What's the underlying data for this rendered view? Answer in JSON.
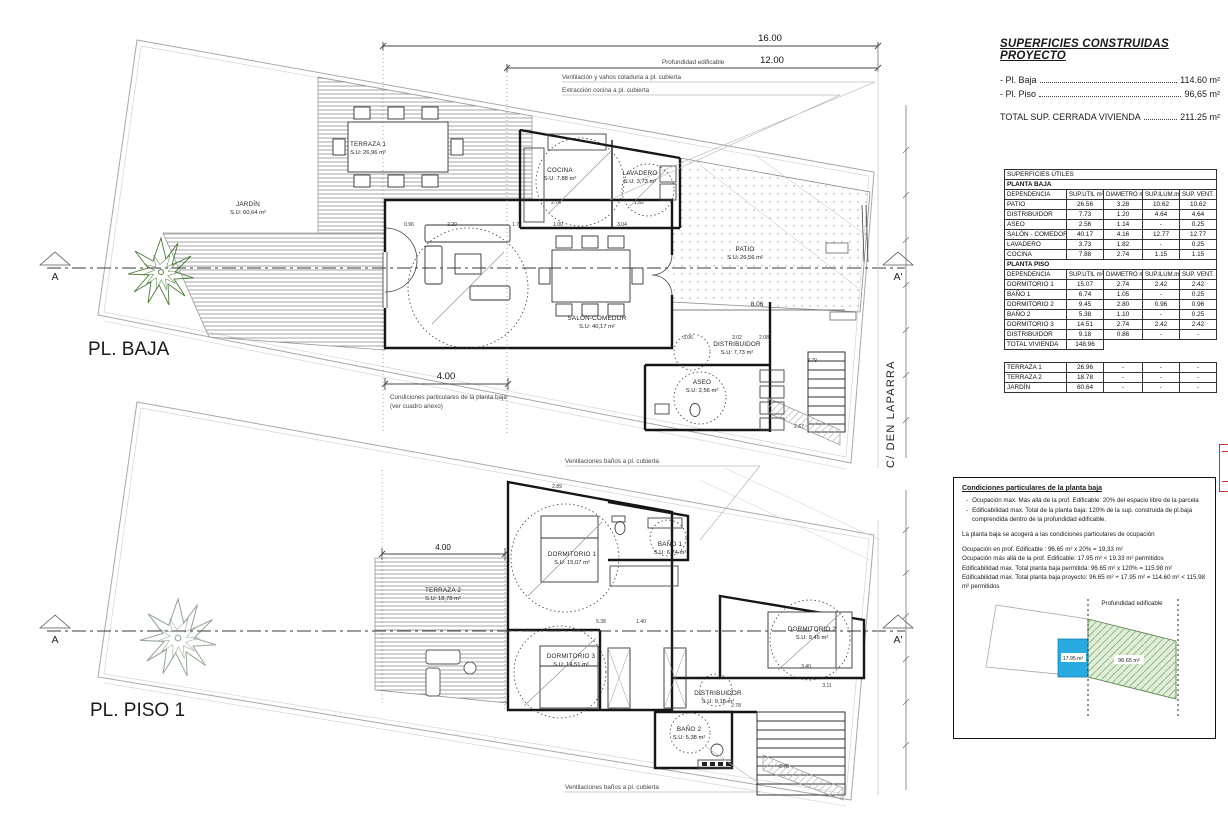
{
  "title_block": {
    "title": "SUPERFICIES CONSTRUIDAS PROYECTO",
    "items": [
      {
        "label": "- Pl. Baja",
        "value": "114.60 m²"
      },
      {
        "label": "- Pl. Piso",
        "value": "96,65 m²"
      }
    ],
    "total_label": "TOTAL SUP. CERRADA VIVIENDA",
    "total_value": "211.25 m²"
  },
  "areas_table": {
    "rows": [
      {
        "kind": "title",
        "cells": [
          "SUPERFICIES ÚTILES"
        ]
      },
      {
        "kind": "section",
        "cells": [
          "PLANTA BAJA"
        ]
      },
      {
        "kind": "header",
        "cells": [
          "DEPENDENCIA",
          "SUP.UTIL m²",
          "DIAMETRO m.",
          "SUP.ILUM.m²",
          "SUP. VENT. m²"
        ]
      },
      {
        "kind": "data",
        "cells": [
          "PATIO",
          "26.56",
          "3.28",
          "10.62",
          "10.62"
        ]
      },
      {
        "kind": "data",
        "cells": [
          "DISTRIBUIDOR",
          "7.73",
          "1.20",
          "4.64",
          "4.64"
        ]
      },
      {
        "kind": "data",
        "cells": [
          "ASEO",
          "2.56",
          "1.14",
          "-",
          "0.25"
        ]
      },
      {
        "kind": "data",
        "cells": [
          "SALÓN - COMEDOR",
          "40.17",
          "4.16",
          "12.77",
          "12.77"
        ]
      },
      {
        "kind": "data",
        "cells": [
          "LAVADERO",
          "3.73",
          "1.82",
          "-",
          "0.25"
        ]
      },
      {
        "kind": "data",
        "cells": [
          "COCINA",
          "7.88",
          "2.74",
          "1.15",
          "1.15"
        ]
      },
      {
        "kind": "section",
        "cells": [
          "PLANTA PISO"
        ]
      },
      {
        "kind": "header",
        "cells": [
          "DEPENDENCIA",
          "SUP.UTIL m²",
          "DIAMETRO m.",
          "SUP.ILUM.m²",
          "SUP. VENT. m²"
        ]
      },
      {
        "kind": "data",
        "cells": [
          "DORMITORIO 1",
          "15.07",
          "2.74",
          "2.42",
          "2.42"
        ]
      },
      {
        "kind": "data",
        "cells": [
          "BAÑO 1",
          "6.74",
          "1.05",
          "-",
          "0.25"
        ]
      },
      {
        "kind": "data",
        "cells": [
          "DORMITORIO 2",
          "9.45",
          "2.80",
          "0.96",
          "0.96"
        ]
      },
      {
        "kind": "data",
        "cells": [
          "BAÑO 2",
          "5.38",
          "1.10",
          "-",
          "0.25"
        ]
      },
      {
        "kind": "data",
        "cells": [
          "DORMITORIO 3",
          "14.51",
          "2.74",
          "2.42",
          "2.42"
        ]
      },
      {
        "kind": "data",
        "cells": [
          "DISTRIBUIDOR",
          "9.18",
          "0.86",
          "-",
          "-"
        ]
      },
      {
        "kind": "total",
        "cells": [
          "TOTAL VIVIENDA",
          "148.96"
        ]
      },
      {
        "kind": "gap",
        "cells": []
      },
      {
        "kind": "data",
        "cells": [
          "TERRAZA 1",
          "26.96",
          "-",
          "-",
          "-"
        ]
      },
      {
        "kind": "data",
        "cells": [
          "TERRAZA 2",
          "18.78",
          "-",
          "-",
          "-"
        ]
      },
      {
        "kind": "data",
        "cells": [
          "JARDÍN",
          "60.64",
          "-",
          "-",
          "-"
        ]
      }
    ]
  },
  "conditions_box": {
    "title": "Condiciones particulares de la planta baja",
    "bullets": [
      "Ocupación max.  Más allá de la prof. Edificable: 20% del espacio libre de la parcela",
      "Edificabilidad max. Total de la planta baja: 120% de la sup. construida de pl.baja comprendida dentro de la profundidad edificable."
    ],
    "note": "La planta baja se acogerá a las condiciones particulares de ocupación",
    "calcs": [
      "Ocupación en prof. Edificable : 96.65 m² x 20% = 19,33 m²",
      "Ocupación más allá de la prof. Edificable: 17.95 m² < 19.33 m² permitidos",
      "Edificabilidad max. Total planta baja permitida: 96.65 m² x 120% = 115.98 m²",
      "Edificabilidad max. Total planta baja proyecto: 96.65 m² + 17.95 m² = 114.60 m² < 115.98 m² permitidos"
    ],
    "diagram": {
      "label": "Profundidad edificable",
      "blue_area": "17.95 m²",
      "green_area": "96.65 m²",
      "blue": "#29abe2",
      "green_fill": "#e0efd7",
      "green_line": "#5a8a4d"
    }
  },
  "plans": {
    "baja": {
      "label": "PL. BAJA",
      "rooms": [
        {
          "name": "TERRAZA 1",
          "su": "S.U: 26,96 m²",
          "x": 368,
          "y": 146
        },
        {
          "name": "COCINA",
          "su": "S.U: 7,88 m²",
          "x": 560,
          "y": 172
        },
        {
          "name": "LAVADERO",
          "su": "S.U: 3,73 m²",
          "x": 640,
          "y": 175
        },
        {
          "name": "JARDÍN",
          "su": "S.U: 60,64 m²",
          "x": 248,
          "y": 206
        },
        {
          "name": "PATIO",
          "su": "S.U: 26,56 m²",
          "x": 745,
          "y": 251
        },
        {
          "name": "SALÓN-COMEDOR",
          "su": "S.U: 40,17 m²",
          "x": 597,
          "y": 320
        },
        {
          "name": "DISTRIBUIDOR",
          "su": "S.U: 7,73 m²",
          "x": 737,
          "y": 346
        },
        {
          "name": "ASEO",
          "su": "S.U: 2,56 m²",
          "x": 702,
          "y": 384
        }
      ]
    },
    "piso": {
      "label": "PL. PISO 1",
      "rooms": [
        {
          "name": "DORMITORIO 1",
          "su": "S.U: 15,07 m²",
          "x": 572,
          "y": 556
        },
        {
          "name": "BAÑO 1",
          "su": "S.U: 6,74 m²",
          "x": 670,
          "y": 546
        },
        {
          "name": "TERRAZA 2",
          "su": "S.U: 18,78 m²",
          "x": 443,
          "y": 592
        },
        {
          "name": "DORMITORIO 2",
          "su": "S.U: 9,45 m²",
          "x": 812,
          "y": 631
        },
        {
          "name": "DORMITORIO 3",
          "su": "S.U: 14,51 m²",
          "x": 571,
          "y": 658
        },
        {
          "name": "DISTRIBUIDOR",
          "su": "S.U: 9,18 m²",
          "x": 718,
          "y": 695
        },
        {
          "name": "BAÑO 2",
          "su": "S.U: 5,38 m²",
          "x": 689,
          "y": 731
        }
      ]
    }
  },
  "street": "C/ DEN LAPARRA",
  "sections": {
    "left": "A",
    "right": "A'"
  },
  "dims_main": {
    "top": "16.00",
    "second": "12.00",
    "baja4": "4.00",
    "piso4": "4.00",
    "patio": "8.06"
  },
  "small_dims": [
    {
      "t": "2.74",
      "x": 556,
      "y": 204
    },
    {
      "t": "1.82",
      "x": 639,
      "y": 204
    },
    {
      "t": "0.96",
      "x": 409,
      "y": 226
    },
    {
      "t": "2.20",
      "x": 452,
      "y": 226
    },
    {
      "t": "1.77",
      "x": 517,
      "y": 226
    },
    {
      "t": "1.00",
      "x": 558,
      "y": 226
    },
    {
      "t": "3.04",
      "x": 622,
      "y": 226
    },
    {
      "t": "3.06",
      "x": 688,
      "y": 339
    },
    {
      "t": "2.02",
      "x": 737,
      "y": 339
    },
    {
      "t": "2.08",
      "x": 764,
      "y": 339
    },
    {
      "t": "2.79",
      "x": 812,
      "y": 362
    },
    {
      "t": "2.67",
      "x": 799,
      "y": 428
    },
    {
      "t": "2.89",
      "x": 557,
      "y": 488
    },
    {
      "t": "5.38",
      "x": 601,
      "y": 623
    },
    {
      "t": "1.40",
      "x": 641,
      "y": 623
    },
    {
      "t": "3.40",
      "x": 806,
      "y": 668
    },
    {
      "t": "3.11",
      "x": 827,
      "y": 687
    },
    {
      "t": "2.78",
      "x": 736,
      "y": 707
    },
    {
      "t": "2.78",
      "x": 784,
      "y": 768
    }
  ],
  "annotations": [
    {
      "t": "Ventilación y vahos coladuria a pl. cubierta",
      "x": 562,
      "y": 79
    },
    {
      "t": "Extracción cocina a pl. cubierta",
      "x": 562,
      "y": 92
    },
    {
      "t": "Profundidad edificable",
      "x": 662,
      "y": 64
    },
    {
      "t": "Condiciones particulares de la planta baja",
      "x": 390,
      "y": 399
    },
    {
      "t": "(ver cuadro anexo)",
      "x": 390,
      "y": 408
    },
    {
      "t": "Ventilaciones baños a pl. cubierta",
      "x": 565,
      "y": 463
    },
    {
      "t": "Ventilaciones baños a pl. cubierta",
      "x": 565,
      "y": 789
    }
  ]
}
